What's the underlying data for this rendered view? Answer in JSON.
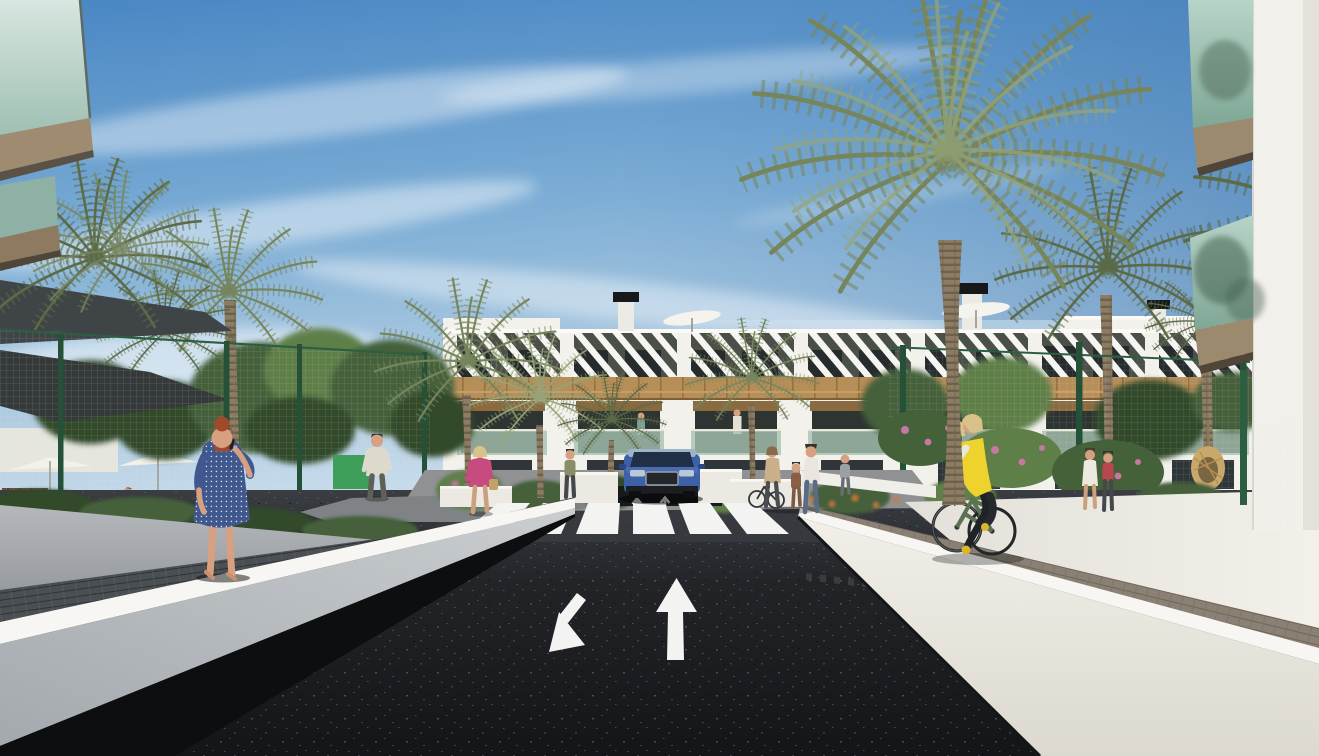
{
  "scene": {
    "type": "architectural-rendering",
    "subject": "New-build white apartment complex seen from its entrance road: palm trees, green mesh fences, a dark asphalt two-way drive with painted arrows and a zebra crossing, a blue SUV leaving the underground garage, a woman in a blue polka-dot dress on the left walkway and a cyclist in a yellow vest on the right walkway",
    "objects": [
      "sky",
      "cirrus-clouds",
      "apartment-building",
      "roof-chimneys",
      "roof-umbrellas",
      "pergola-slats",
      "wood-cladding-band",
      "balconies",
      "glass-balustrades",
      "palm-trees",
      "leafy-trees",
      "green-mesh-fence",
      "shade-sail",
      "patio-umbrellas",
      "asphalt-road",
      "zebra-crosswalk",
      "road-arrow-up",
      "road-arrow-down-left",
      "left-retaining-wall",
      "right-retaining-wall",
      "left-walkway",
      "right-paver-walkway",
      "blue-suv",
      "woman-in-blue-dress",
      "cyclist-in-yellow-vest",
      "pedestrians",
      "foreground-balcony-left",
      "foreground-building-right",
      "flower-shrubs",
      "hanging-wicker-chair"
    ]
  },
  "palette": {
    "sky_top": "#4886c3",
    "sky_mid": "#7cadd5",
    "sky_horizon": "#cadded",
    "cloud": "#ffffff",
    "building_white": "#f3f1ec",
    "building_shade": "#e0ded6",
    "wood": "#b68e58",
    "wood_dark": "#8a6a3e",
    "window_dark": "#2e3431",
    "glass_green": "#a7c3b1",
    "asphalt": "#1b1d20",
    "asphalt_light": "#35383d",
    "road_marking": "#f3f4f1",
    "wall_bright": "#ebe9e2",
    "wall_gray": "#bfc3c6",
    "wall_gray_dark": "#989da1",
    "paver_warm": "#8a8073",
    "paver_dark": "#4a4f53",
    "fence_green": "#2c5f41",
    "palm": "#76855c",
    "palm_dark": "#5b6a47",
    "palm_light": "#96a478",
    "trunk": "#8c7c63",
    "trunk_dark": "#6e604b",
    "foliage": "#44613a",
    "foliage_dark": "#32492a",
    "foliage_light": "#5f7f49",
    "car_blue": "#3d61a7",
    "car_blue_dark": "#2b4784",
    "vest_yellow": "#eed32e",
    "dress_blue": "#40588e",
    "hair_auburn": "#a14a2a",
    "skin": "#d7a081",
    "top_pink": "#c84b80",
    "bag_tan": "#c3a167",
    "shirt_white": "#ddd9cc",
    "jeans_blue": "#5a6b85"
  }
}
